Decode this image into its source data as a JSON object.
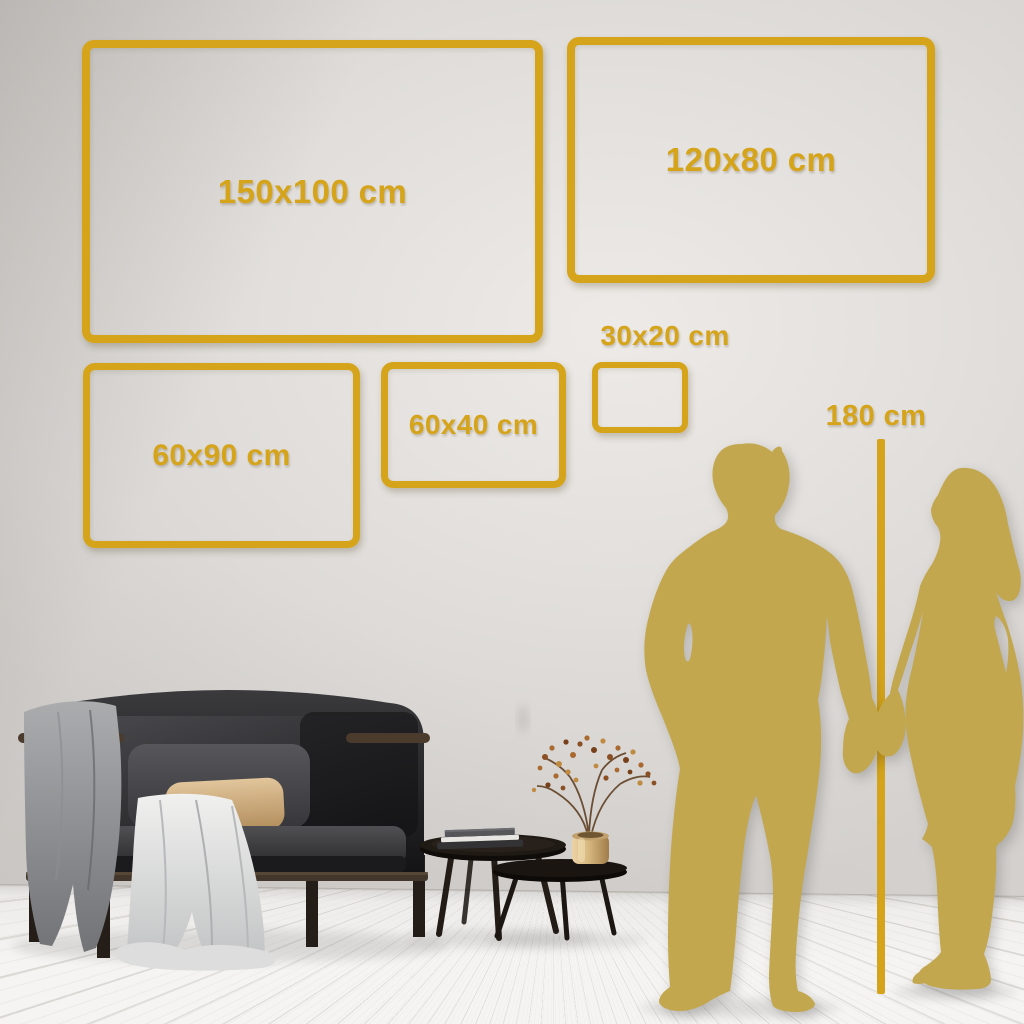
{
  "colors": {
    "accent_gold": "#D5A41B",
    "silhouette_gold": "#C2A74E",
    "wall": "#E2DFDC",
    "floor": "#F5F4F2"
  },
  "size_frames": [
    {
      "id": "150x100",
      "label": "150x100 cm",
      "label_placement": "inside"
    },
    {
      "id": "120x80",
      "label": "120x80 cm",
      "label_placement": "inside"
    },
    {
      "id": "60x90",
      "label": "60x90 cm",
      "label_placement": "inside"
    },
    {
      "id": "60x40",
      "label": "60x40 cm",
      "label_placement": "inside"
    },
    {
      "id": "30x20",
      "label": "30x20 cm",
      "label_placement": "above"
    }
  ],
  "height_reference": {
    "label": "180 cm"
  },
  "scene": {
    "wall": "light-gray-plaster",
    "floor": "white-washed-wood-planks",
    "furniture": [
      "black-velvet-loveseat",
      "wood-sofa-frame",
      "gray-throw-blanket",
      "white-draped-cloth",
      "charcoal-back-cushion",
      "beige-lumbar-pillow",
      "nesting-round-coffee-tables",
      "stacked-books",
      "brass-vase",
      "dried-berry-branches"
    ],
    "figures": [
      "man-silhouette",
      "woman-silhouette",
      "height-reference-line"
    ]
  }
}
